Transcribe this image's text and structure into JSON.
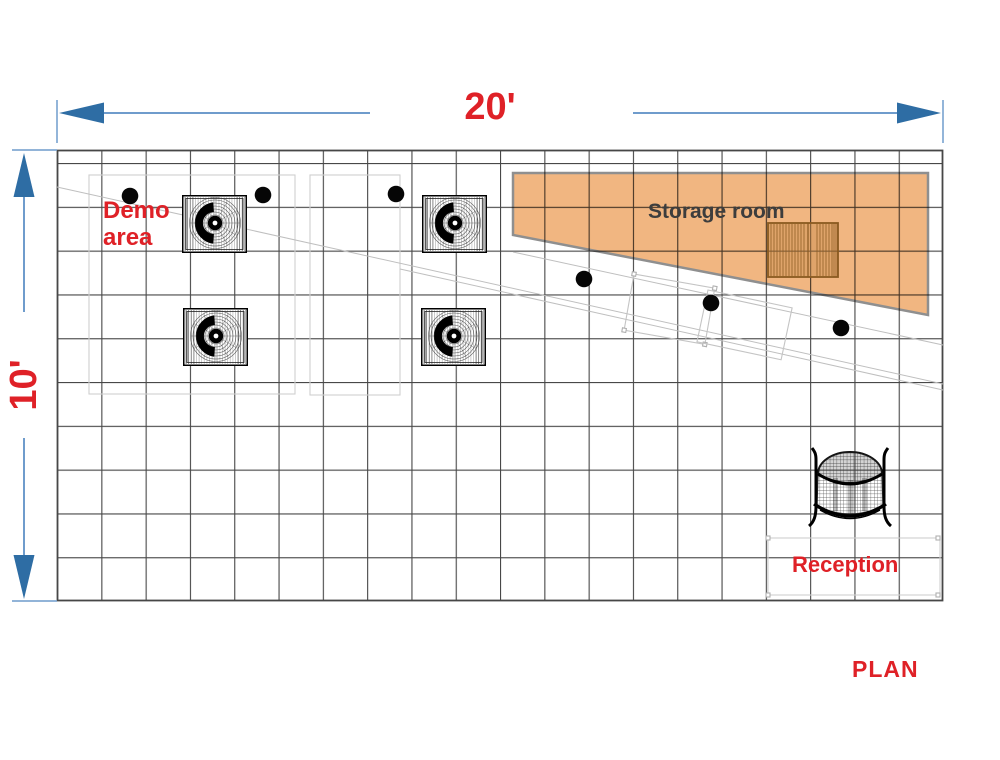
{
  "plan": {
    "title": "PLAN",
    "dimensions": {
      "width_label": "20'",
      "height_label": "10'"
    },
    "rooms": {
      "demo_area_label": "Demo\narea",
      "storage_room_label": "Storage room",
      "reception_label": "Reception"
    },
    "grid": {
      "columns": 20,
      "rows": 10
    },
    "objects": {
      "demo_chairs": 4,
      "floor_dots": 6,
      "storage_crate": 1,
      "display_tables": 2,
      "reception_desk": 1
    },
    "colors": {
      "label_red": "#df2127",
      "storage_text_gray": "#3d3d3d",
      "dimension_line_blue": "#6f9ccc",
      "dimension_arrow_blue": "#2e6da4",
      "storage_fill_orange": "#f0b076",
      "grid_line_gray": "#474747"
    }
  }
}
